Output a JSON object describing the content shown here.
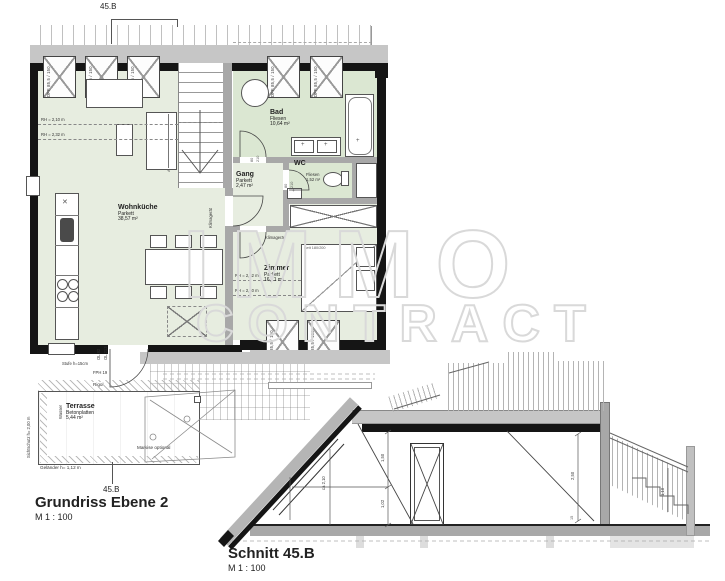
{
  "colors": {
    "room-green": "#e7ede0",
    "bad-green": "#dbe7d2",
    "wall-black": "#151515",
    "wall-gray": "#a8a8a8",
    "band-gray": "#c6c6c6",
    "watermark": "#d9d9d9"
  },
  "watermark": {
    "line1": "IMMO",
    "line2": "CONTRACT"
  },
  "plan": {
    "title": "Grundriss Ebene 2",
    "scale": "M 1 : 100",
    "section_marker": "45.B",
    "window_label": "DFF 85,5 / 150",
    "rooms": {
      "wohnkueche": {
        "name": "Wohnküche",
        "floor": "Parkett",
        "area": "38,57 m²"
      },
      "bad": {
        "name": "Bad",
        "floor": "Fliesen",
        "area": "10,64 m²"
      },
      "wc": {
        "name": "WC",
        "floor": "Fliesen",
        "area": "1,52 m²"
      },
      "gang": {
        "name": "Gang",
        "floor": "Parkett",
        "area": "2,47 m²"
      },
      "zimmer": {
        "name": "Zimmer",
        "floor": "Parkett",
        "area": "16,71 m²"
      },
      "terrasse": {
        "name": "Terrasse",
        "floor": "Betonplatten",
        "area": "5,44 m²"
      }
    },
    "heights": {
      "wk1": "RH = 2,10 m",
      "wk2": "RH = 2,32 m",
      "zi1": "RH = 2,52 m",
      "zi2": "RH = 2,10 m"
    },
    "labels": {
      "bett": "Bett 180/200",
      "klima": "Klimagerät",
      "stufe": "Stufe h=15cm",
      "ol82": "OL 82",
      "ol213": "OL 213",
      "fph": "FPH 19",
      "rigol": "Rigol",
      "sichtschutz": "Sichtschutz h= 2,00 m",
      "wasser": "Wasser",
      "markise": "Markise optional",
      "gelaender": "Geländer h= 1,12 m",
      "absturz": "Absturzsicherung h=1,00 m",
      "door_w": "80",
      "door_h": "210"
    }
  },
  "section": {
    "title": "Schnitt 45.B",
    "scale": "M 1 : 100",
    "dims": {
      "a": "1,50",
      "b": "1,02",
      "c": "ca 2,10",
      "d": "1,19",
      "e": "2,50",
      "f": "1,10",
      "g": "15"
    }
  }
}
